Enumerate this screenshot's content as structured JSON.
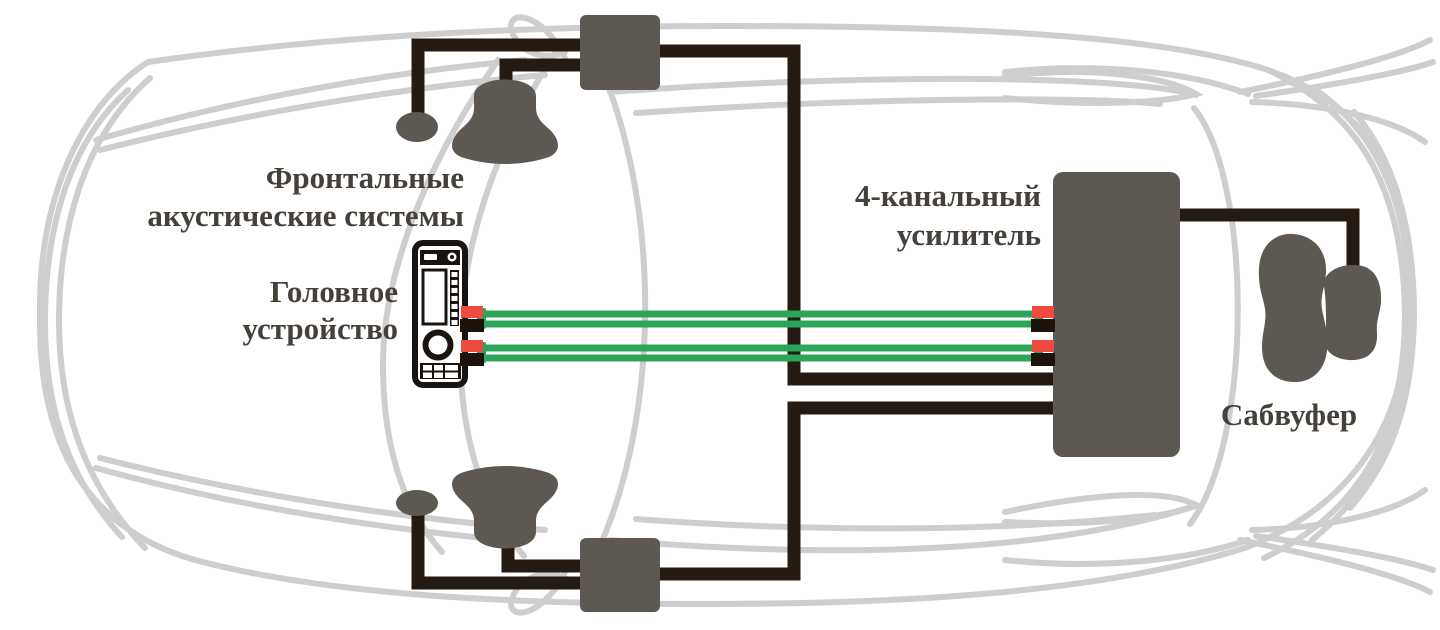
{
  "labels": {
    "front_speakers": {
      "line1": "Фронтальные",
      "line2": "акустические системы"
    },
    "head_unit": {
      "line1": "Головное",
      "line2": "устройство"
    },
    "amplifier": {
      "line1": "4-канальный",
      "line2": "усилитель"
    },
    "subwoofer": {
      "line1": "Сабвуфер"
    }
  },
  "colors": {
    "background": "#ffffff",
    "car_outline": "#cecece",
    "wire": "#241a11",
    "component_fill": "#5e5852",
    "head_unit_frame": "#191410",
    "rca_cable_green": "#2ca45a",
    "connector_red": "#ee4a3f",
    "connector_black": "#1c130d",
    "label_text": "#46403a"
  }
}
